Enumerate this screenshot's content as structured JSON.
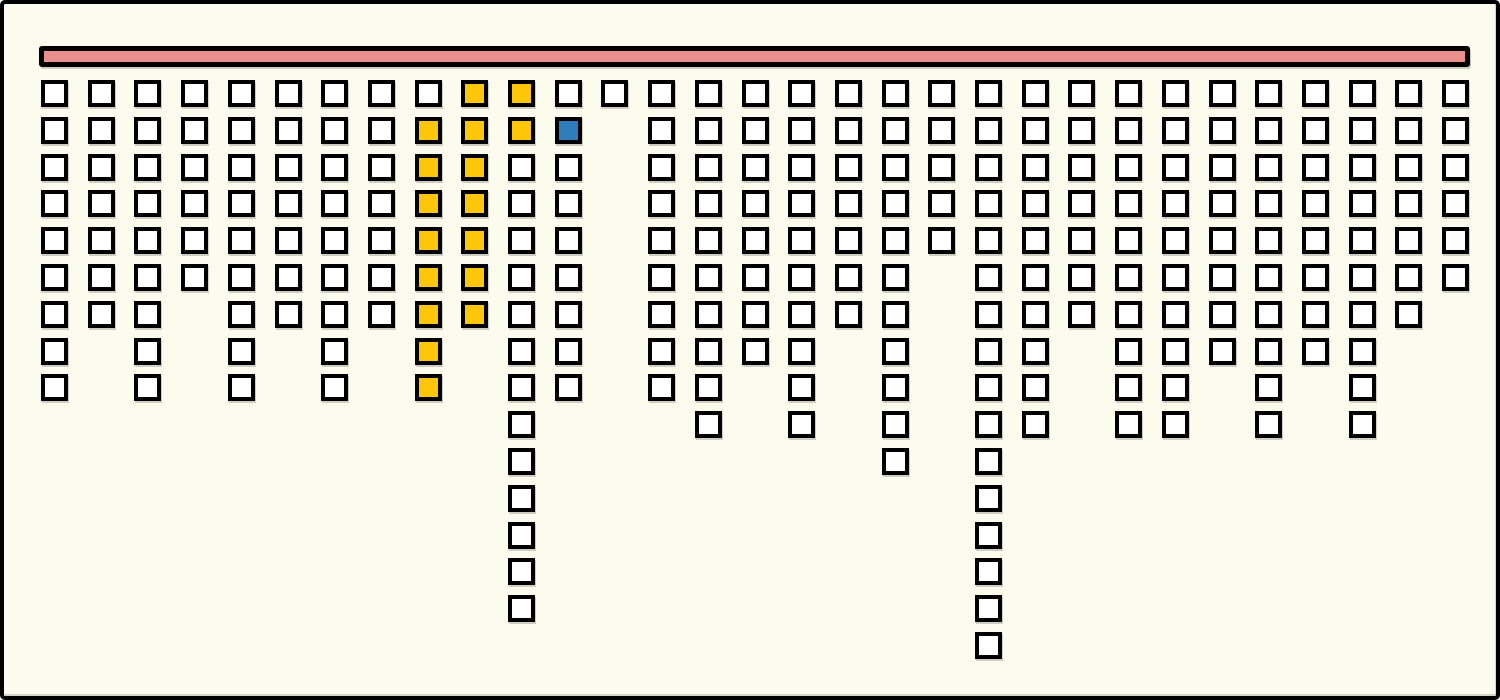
{
  "chart_data": {
    "type": "bar",
    "subtype": "unit-square-columns-hanging-from-bar",
    "title": "",
    "xlabel": "",
    "ylabel": "",
    "legend": "none",
    "axes": "none",
    "grid": "off",
    "orientation": "columns hang downward from a horizontal header bar",
    "column_count": 31,
    "max_rows": 16,
    "values": [
      9,
      7,
      9,
      6,
      9,
      7,
      9,
      7,
      9,
      7,
      15,
      9,
      1,
      9,
      10,
      8,
      10,
      7,
      11,
      5,
      16,
      10,
      7,
      10,
      10,
      8,
      10,
      8,
      10,
      7,
      6
    ],
    "categories": [
      1,
      2,
      3,
      4,
      5,
      6,
      7,
      8,
      9,
      10,
      11,
      12,
      13,
      14,
      15,
      16,
      17,
      18,
      19,
      20,
      21,
      22,
      23,
      24,
      25,
      26,
      27,
      28,
      29,
      30,
      31
    ],
    "highlights": [
      {
        "column": 9,
        "row_from": 2,
        "row_to": 9,
        "color_name": "yellow"
      },
      {
        "column": 10,
        "row_from": 1,
        "row_to": 7,
        "color_name": "yellow"
      },
      {
        "column": 11,
        "row_from": 1,
        "row_to": 2,
        "color_name": "yellow"
      },
      {
        "column": 12,
        "row_from": 2,
        "row_to": 2,
        "color_name": "blue"
      }
    ],
    "highlight_counts": {
      "yellow": 17,
      "blue": 1
    },
    "colors": {
      "background": "#FBFBEE",
      "square_fill": "#FFFFFF",
      "square_outline": "#000000",
      "yellow": "#FDC608",
      "blue": "#2E7DBD",
      "header_bar_fill": "#E9908E",
      "header_bar_outline": "#000000"
    }
  }
}
